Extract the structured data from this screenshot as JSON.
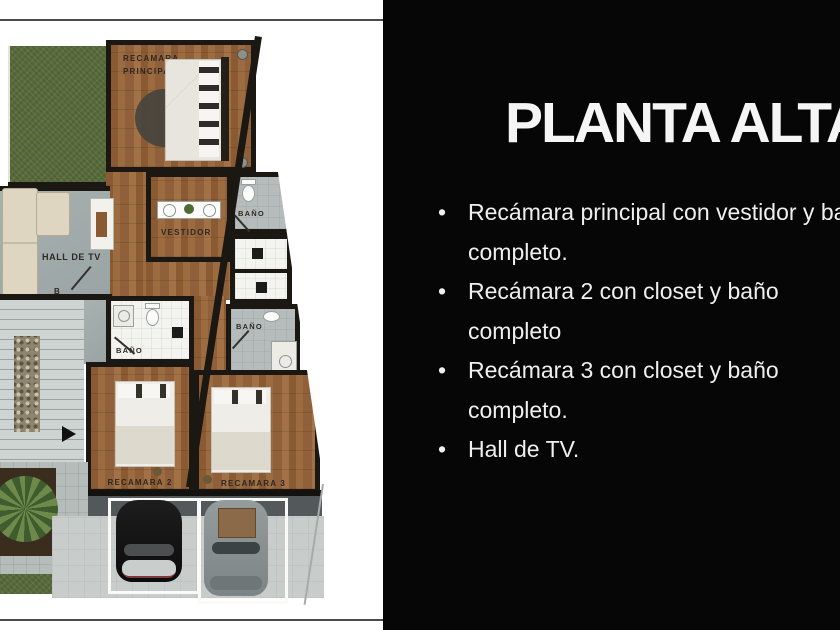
{
  "panel": {
    "title": "PLANTA ALTA",
    "bullet_char": "•",
    "bullets": [
      {
        "lines": [
          "Recámara principal con vestidor y baño",
          "completo."
        ]
      },
      {
        "lines": [
          "Recámara 2 con closet y baño",
          "completo"
        ]
      },
      {
        "lines": [
          "Recámara 3 con closet y baño",
          "completo."
        ]
      },
      {
        "lines": [
          "Hall de TV."
        ]
      }
    ]
  },
  "plan": {
    "labels": {
      "rp1": "RECAMARA",
      "rp2": "PRINCIPAL",
      "bano": "BAÑO",
      "vestidor": "VESTIDOR",
      "hall": "HALL DE TV",
      "rec2": "RECAMARA 2",
      "rec3": "RECAMARA 3",
      "b": "B"
    },
    "colors": {
      "panel_bg": "#060606",
      "panel_text": "#efefef",
      "wall": "#1b1712",
      "wood": "#96683e",
      "concrete": "#a2acab",
      "grass": "#596c3b",
      "driveway": "#c8cdcb"
    }
  }
}
